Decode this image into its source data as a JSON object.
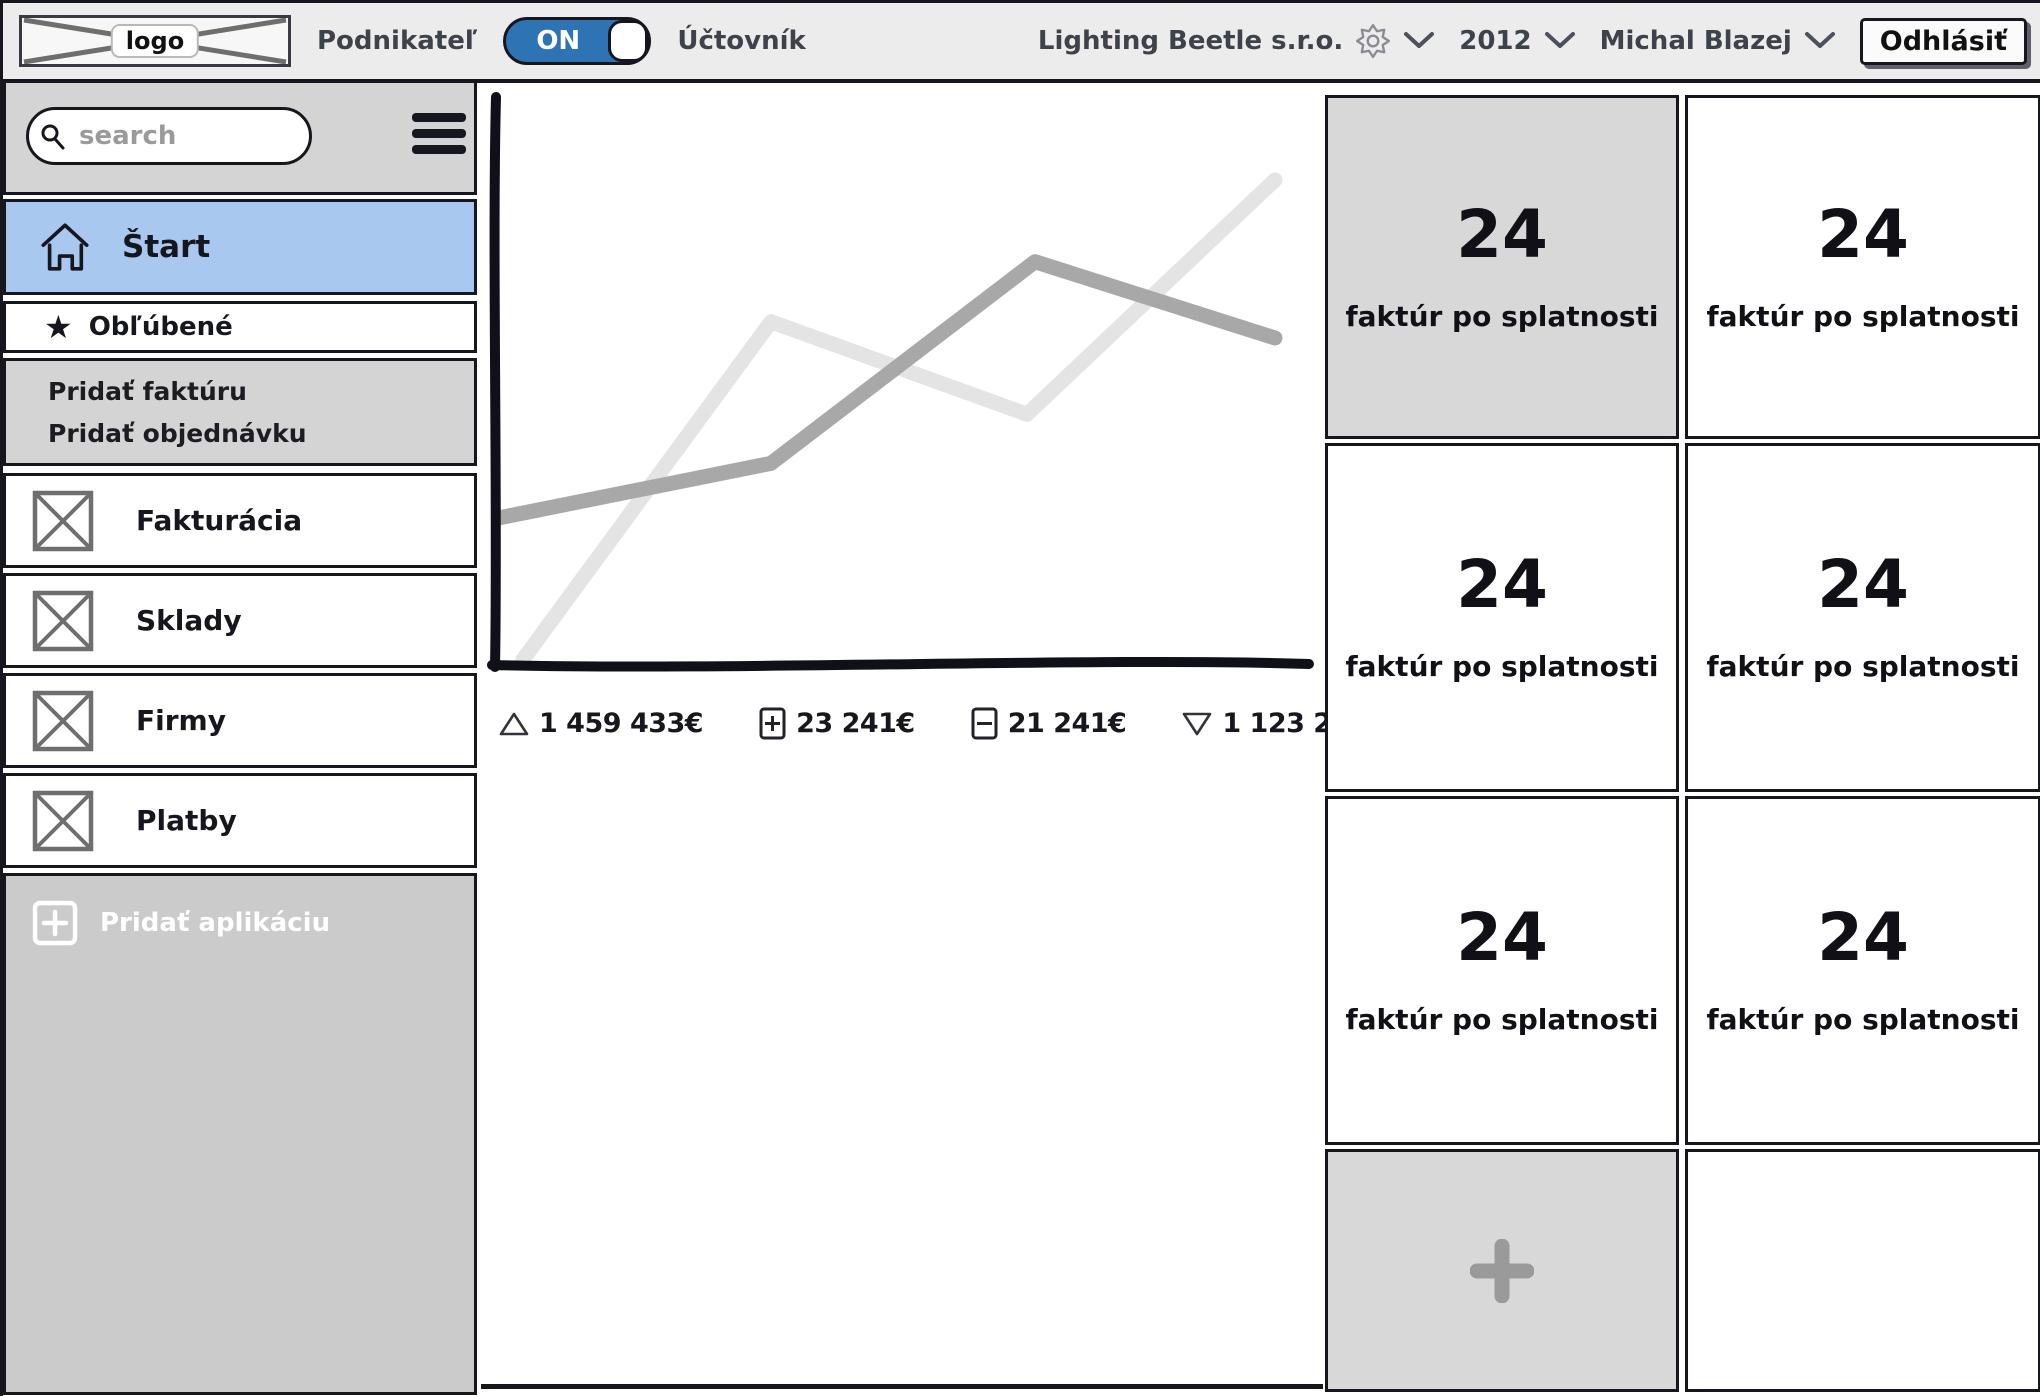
{
  "topbar": {
    "logo_label": "logo",
    "left_role": "Podnikateľ",
    "toggle_on_label": "ON",
    "right_role": "Účtovník",
    "company": "Lighting Beetle s.r.o.",
    "year": "2012",
    "user": "Michal Blazej",
    "logout_label": "Odhlásiť"
  },
  "sidebar": {
    "search_placeholder": "search",
    "start_label": "Štart",
    "favorites_label": "Obľúbené",
    "quick_actions": [
      {
        "label": "Pridať faktúru"
      },
      {
        "label": "Pridať objednávku"
      }
    ],
    "nav": [
      {
        "label": "Fakturácia"
      },
      {
        "label": "Sklady"
      },
      {
        "label": "Firmy"
      },
      {
        "label": "Platby"
      }
    ],
    "add_app_label": "Pridať aplikáciu"
  },
  "chart_data": {
    "type": "line",
    "title": "",
    "axes_labeled": false,
    "grid": false,
    "series": [
      {
        "name": "series-light",
        "color": "#e4e4e4",
        "points_pct": [
          [
            3,
            1
          ],
          [
            34,
            63
          ],
          [
            66,
            46
          ],
          [
            97,
            89
          ]
        ]
      },
      {
        "name": "series-dark",
        "color": "#a8a8a8",
        "points_pct": [
          [
            0,
            27
          ],
          [
            34,
            37
          ],
          [
            67,
            74
          ],
          [
            97,
            60
          ]
        ]
      }
    ],
    "legend": [
      {
        "icon": "triangle-up-icon",
        "value": "1 459 433€"
      },
      {
        "icon": "plus-box-icon",
        "value": "23 241€"
      },
      {
        "icon": "minus-box-icon",
        "value": "21 241€"
      },
      {
        "icon": "triangle-down-icon",
        "value": "1 123 241€"
      }
    ]
  },
  "cards": {
    "items": [
      {
        "value": "24",
        "label": "faktúr po splatnosti"
      },
      {
        "value": "24",
        "label": "faktúr po splatnosti"
      },
      {
        "value": "24",
        "label": "faktúr po splatnosti"
      },
      {
        "value": "24",
        "label": "faktúr po splatnosti"
      },
      {
        "value": "24",
        "label": "faktúr po splatnosti"
      },
      {
        "value": "24",
        "label": "faktúr po splatnosti"
      }
    ]
  },
  "colors": {
    "ink": "#16161e",
    "topbar_bg": "#ececec",
    "panel_gray": "#d4d4d4",
    "card_gray": "#d8d8d8",
    "selected_item_blue": "#a9c8ef",
    "toggle_blue": "#2e74b5",
    "chart_line_light": "#e4e4e4",
    "chart_line_dark": "#a8a8a8"
  }
}
